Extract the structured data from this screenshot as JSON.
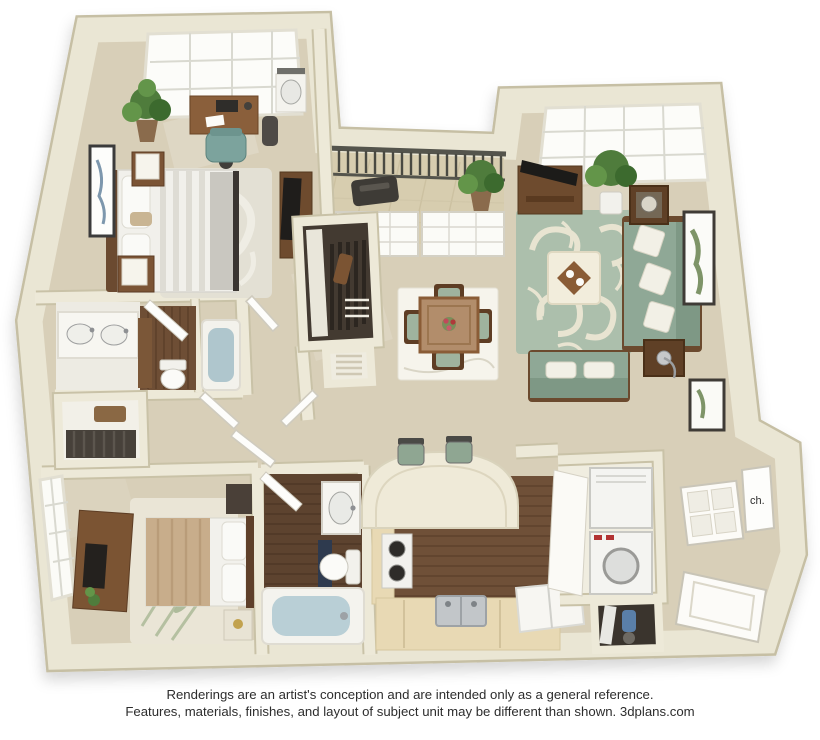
{
  "canvas": {
    "width": 820,
    "height": 740,
    "background": "#ffffff"
  },
  "floorplan": {
    "kind": "3D apartment floor plan rendering",
    "bedrooms_shown": 2,
    "bathrooms_shown": 2,
    "water_heater_label": "ch.",
    "rooms": [
      {
        "name": "master bedroom",
        "contents": [
          "queen bed with striped duvet",
          "two nightstands with cube lamps",
          "desk with laptop",
          "teal desk chair",
          "potted plant",
          "wall art",
          "corner vanity sink",
          "dresser with tv",
          "skylight window",
          "area rug"
        ]
      },
      {
        "name": "master bathroom",
        "contents": [
          "double sink vanity",
          "toilet",
          "bathtub",
          "linen cabinet",
          "wood floor"
        ]
      },
      {
        "name": "walk-in closet",
        "contents": [
          "hanging clothes",
          "wire shelves"
        ]
      },
      {
        "name": "hallway",
        "contents": [
          "linen closet with towels",
          "white doors"
        ]
      },
      {
        "name": "bedroom 2",
        "contents": [
          "bed with tan duvet",
          "dresser with tv",
          "nightstands",
          "bamboo print rug",
          "window"
        ]
      },
      {
        "name": "bathroom 2",
        "contents": [
          "vanity sink",
          "toilet",
          "bathtub",
          "dark wood floor",
          "door"
        ]
      },
      {
        "name": "kitchen",
        "contents": [
          "range",
          "stainless double sink",
          "refrigerator",
          "curved breakfast bar",
          "two bar stools",
          "wood floor",
          "tan counters"
        ]
      },
      {
        "name": "laundry closet",
        "contents": [
          "stacked washer and dryer"
        ]
      },
      {
        "name": "storage closet",
        "contents": [
          "ironing board",
          "vacuum"
        ]
      },
      {
        "name": "dining area",
        "contents": [
          "square wood table",
          "four chairs with sage cushions",
          "flower centerpiece",
          "white area rug"
        ]
      },
      {
        "name": "living room",
        "contents": [
          "sage sofa with patterned pillows",
          "loveseat",
          "cream ottoman with tray",
          "two end tables with lamps",
          "tv console with tv",
          "damask sage rug",
          "potted tree",
          "framed art",
          "skylight window"
        ]
      },
      {
        "name": "balcony",
        "contents": [
          "metal railing",
          "potted plant",
          "grill",
          "tiled floor",
          "sliding glass doors"
        ]
      },
      {
        "name": "entry",
        "contents": [
          "front door",
          "coat closet door",
          "water heater closet",
          "framed art",
          "wall panel"
        ]
      }
    ],
    "palette": {
      "wall": "#ebe7d5",
      "wall_edge": "#c7c0a5",
      "carpet": "#d8cfb8",
      "wood_floor": "#6f5038",
      "dark_wood_floor": "#5d432f",
      "wood_furniture": "#7b5433",
      "sofa_green": "#8fa896",
      "rug_sage": "#acbfac",
      "rug_cream": "#e8e4d1",
      "counter_tan": "#e8d9b4",
      "bedding_white": "#f1f0eb",
      "bedding_tan": "#c8ad8b",
      "water_blue": "#b5cbd3",
      "railing_dark": "#4d4d47",
      "plant_green": "#4f7c3c",
      "text_color": "#2d2d2d"
    }
  },
  "disclaimer": {
    "line1": "Renderings are an artist's conception and are intended only as a general reference.",
    "line2": "Features, materials, finishes, and layout of subject unit may be different than shown. 3dplans.com"
  }
}
